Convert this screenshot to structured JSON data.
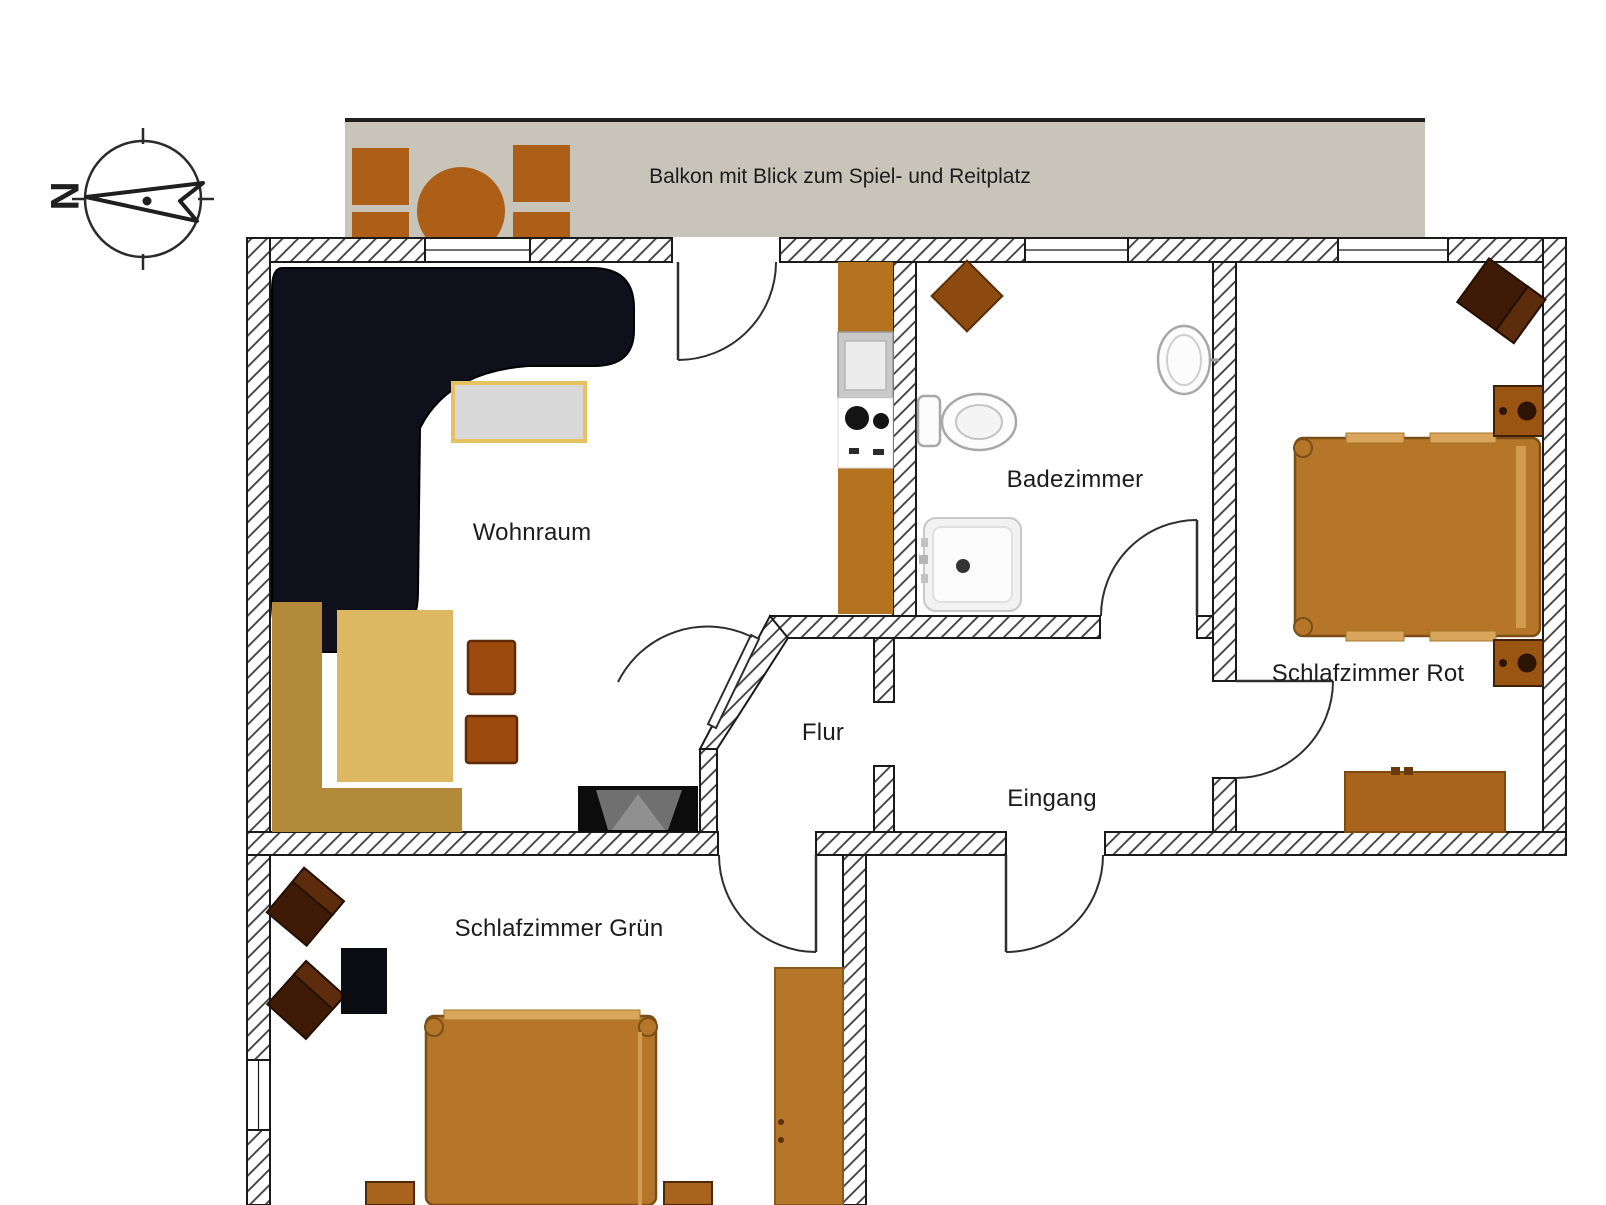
{
  "compass": {
    "north_label": "N"
  },
  "balcony": {
    "label": "Balkon mit Blick zum Spiel- und Reitplatz"
  },
  "rooms": {
    "wohnraum": {
      "label": "Wohnraum"
    },
    "badezimmer": {
      "label": "Badezimmer"
    },
    "schlafzimmer_rot": {
      "label": "Schlafzimmer Rot"
    },
    "flur": {
      "label": "Flur"
    },
    "eingang": {
      "label": "Eingang"
    },
    "schlafzimmer_gruen": {
      "label": "Schlafzimmer Grün"
    }
  },
  "colors": {
    "balcony_bg": "#c8c4b9",
    "balcony_furniture": "#ad5f17",
    "wall_hatch_line": "#3c3c3c",
    "wall_outline": "#1a1a1a",
    "sofa": "#10101c",
    "coffee_table_fill": "#d8d8d8",
    "coffee_table_border": "#e3c25f",
    "bench": "#b3893a",
    "dining_table": "#ddb863",
    "chair": "#9c4a0e",
    "kitchen_counter": "#b5721f",
    "bed": "#b5762a",
    "bed_frame_light": "#d9a55c",
    "nightstand": "#9a5512",
    "dresser": "#a8641c",
    "dark_armchair": "#3f1b07",
    "black_table": "#0b0b12",
    "bath_fixture_stroke": "#a8a8a8",
    "label_text": "#1c1c1c"
  },
  "furniture": {
    "balcony": [
      "chair",
      "chair",
      "chair",
      "chair",
      "round-table"
    ],
    "wohnraum": [
      "corner-sofa",
      "coffee-table",
      "corner-bench",
      "dining-table",
      "chair",
      "chair",
      "tv-sideboard",
      "kitchen-cabinet",
      "kitchen-sink",
      "cooktop",
      "kitchen-counter"
    ],
    "badezimmer": [
      "corner-cabinet",
      "toilet",
      "washbasin",
      "shower"
    ],
    "schlafzimmer_rot": [
      "armchair",
      "nightstand",
      "double-bed",
      "nightstand",
      "dresser"
    ],
    "schlafzimmer_gruen": [
      "armchair",
      "armchair",
      "side-table",
      "double-bed",
      "nightstand",
      "nightstand",
      "wardrobe"
    ]
  }
}
